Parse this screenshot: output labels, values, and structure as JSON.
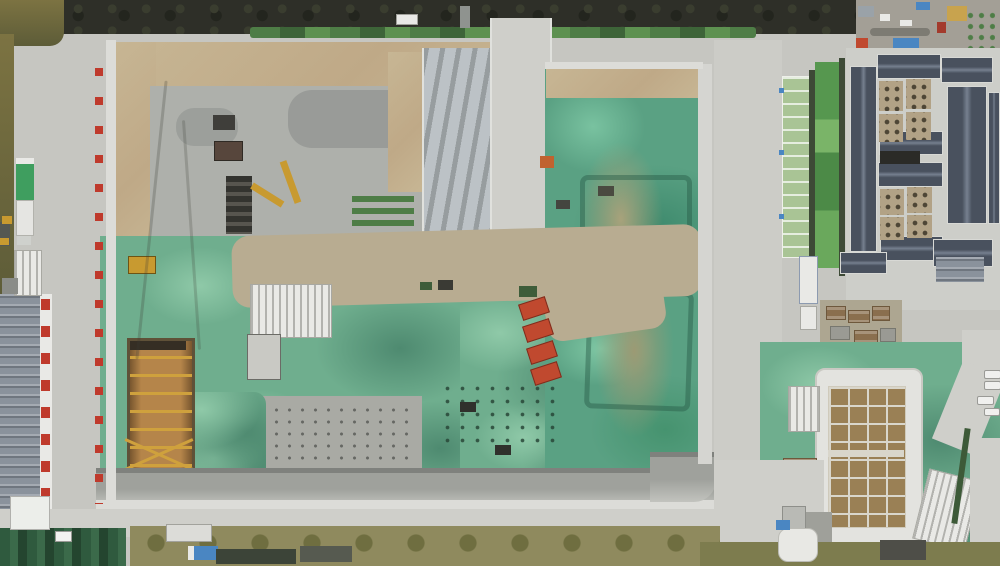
{
  "scene": {
    "type": "aerial-drone-photo",
    "subject": "Top-down aerial view of a large construction site: excavation pits with green dust-control netting, gray concrete base slab, perimeter haul roads with red safety markers along the retaining wall, an orange deep shaft with yellow struts, a row of red pile-drilling rigs, a traditional gray-roofed building complex with tree courtyards on the right, an industrial shed with red signage on the left, and a foundation grid under white insulation at the lower right",
    "time_of_day": "late afternoon, low warm sun",
    "counts": {
      "wall_markers": 16,
      "drill_rigs": 4,
      "courtyards": 8,
      "parked_cars": 4,
      "ridge_outlines": 2
    },
    "palette": {
      "road": "#c6c6c1",
      "road_bright": "#cfcfca",
      "concrete_slab": "#aeb0ab",
      "concrete_dark": "#8e918e",
      "dirt_tan": "#c7b694",
      "dirt_junction": "#b8ac91",
      "green_net": "#6fae8e",
      "green_net_light": "#8fc9a8",
      "green_net_dark": "#4e8a70",
      "teal_net": "#5aa183",
      "mound_tan": "#a8a27b",
      "wall_white": "#dcdcd8",
      "wall_dark": "#7f817d",
      "tree_dark": "#2e2f28",
      "tree_olive": "#6f6a3f",
      "hedge_green": "#4e7d46",
      "turf_green": "#56974f",
      "roof_slate": "#49515e",
      "roof_slate_light": "#76808f",
      "courtyard_tan": "#b2a286",
      "roof_green": "#a9c495",
      "staging_gray": "#a39f96",
      "pit_orange": "#b5854a",
      "pit_wall_brown": "#5f5138",
      "strut_yellow": "#cfa13d",
      "machine_yellow": "#c89a30",
      "machine_red": "#c0492f",
      "sign_red": "#bf3a2c",
      "tarp_blue": "#4a86c2",
      "tarp_green": "#3f9e5f",
      "white": "#e9e9e6",
      "veg_olive": "#8f8a5e",
      "grass_olive": "#7d7c4e",
      "foundation_brown": "#9a8055",
      "foundation_grid": "#d9d6cb",
      "ribbed_roof": "#8a929c"
    }
  }
}
